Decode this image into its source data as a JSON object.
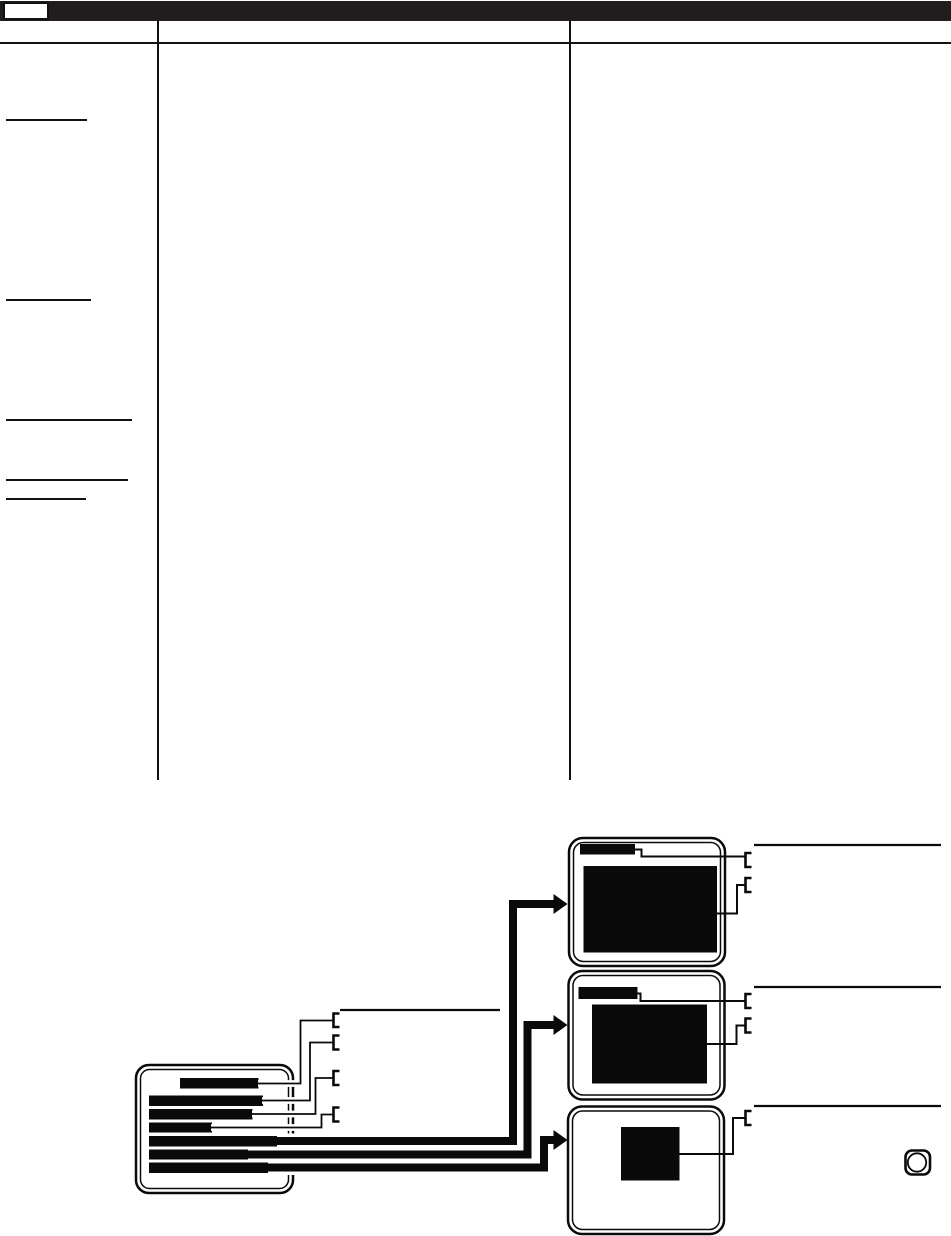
{
  "page": {
    "width": 951,
    "height": 1236,
    "background": "#ffffff",
    "ink_color": "#0a0a0a",
    "header_bar_color": "#211d1e",
    "page_number_box_label": ""
  },
  "left_column": {
    "redacted_heading_rules": [
      {
        "x": 6,
        "y": 118.5,
        "w": 81
      },
      {
        "x": 6,
        "y": 298.5,
        "w": 85
      },
      {
        "x": 6,
        "y": 418.5,
        "w": 126
      },
      {
        "x": 6,
        "y": 478.8,
        "w": 122
      },
      {
        "x": 6,
        "y": 497.8,
        "w": 80
      }
    ]
  },
  "diagram": {
    "menu_screen": {
      "frame": {
        "x": 136,
        "y": 1065,
        "w": 157,
        "h": 128,
        "r": 13
      },
      "menu_item_bars": [
        {
          "x": 180,
          "y": 1078,
          "w": 78.5,
          "h": 10.5,
          "role": "menu-title-bar"
        },
        {
          "x": 149,
          "y": 1095.5,
          "w": 114,
          "h": 10.5,
          "role": "menu-item-bar"
        },
        {
          "x": 149,
          "y": 1109,
          "w": 103.5,
          "h": 10.5,
          "role": "menu-item-bar"
        },
        {
          "x": 149,
          "y": 1122.5,
          "w": 63,
          "h": 10,
          "role": "menu-item-bar"
        },
        {
          "x": 149,
          "y": 1136,
          "w": 129,
          "h": 10.5,
          "role": "menu-item-bar"
        },
        {
          "x": 149,
          "y": 1149.5,
          "w": 101,
          "h": 10,
          "role": "menu-item-bar"
        },
        {
          "x": 149,
          "y": 1162.5,
          "w": 121,
          "h": 10.5,
          "role": "menu-item-bar"
        }
      ],
      "callout_lines": [
        "M211,1127.5 H321.5 V1114.5 H333",
        "M252,1114 H315.5 V1078 H333",
        "M262,1100.5 H310 V1042.5 H333",
        "M258,1083.5 H300.5 V1020.5 H333"
      ],
      "callout_brackets": [
        {
          "x": 333.5,
          "y1": 1013.5,
          "y2": 1027
        },
        {
          "x": 333.5,
          "y1": 1035.5,
          "y2": 1049.5
        },
        {
          "x": 333.5,
          "y1": 1071,
          "y2": 1085
        },
        {
          "x": 333.5,
          "y1": 1107.5,
          "y2": 1121.5
        }
      ],
      "label_rule": {
        "x1": 340,
        "y": 1010,
        "x2": 500
      }
    },
    "arrows": [
      {
        "path": "M277,1141 H513 V904 H554",
        "tip": [
          567.5,
          904
        ]
      },
      {
        "path": "M248,1154.5 H527.5 V1025 H554",
        "tip": [
          567.5,
          1025
        ]
      },
      {
        "path": "M268,1167.5 H544 V1140 H554",
        "tip": [
          567.5,
          1140
        ]
      }
    ],
    "tv_screens": [
      {
        "name": "tv-screen-1",
        "frame": {
          "x": 569,
          "y": 838,
          "w": 156,
          "h": 128,
          "r": 14
        },
        "title_bar": {
          "x": 580,
          "y": 844,
          "w": 55,
          "h": 10.5
        },
        "content_rect": {
          "x": 583.5,
          "y": 866,
          "w": 133.5,
          "h": 86.5
        },
        "callouts": [
          {
            "line": "M635,849.5 H641.5 V856.5 H745.5",
            "bracket": {
              "x": 745.5,
              "y1": 853,
              "y2": 867
            }
          },
          {
            "line": "M745.5,885 H737 V913.5 H717",
            "bracket": {
              "x": 745.5,
              "y1": 878,
              "y2": 892
            }
          }
        ],
        "label_rule": {
          "x1": 754,
          "y": 845,
          "x2": 941
        }
      },
      {
        "name": "tv-screen-2",
        "frame": {
          "x": 568.5,
          "y": 971,
          "w": 156,
          "h": 128.5,
          "r": 14
        },
        "title_bar": {
          "x": 578.5,
          "y": 987,
          "w": 59,
          "h": 12
        },
        "content_rect": {
          "x": 592,
          "y": 1004.5,
          "w": 115,
          "h": 79
        },
        "callouts": [
          {
            "line": "M637.5,993.5 H640.5 V1001 H745.5",
            "bracket": {
              "x": 745.5,
              "y1": 994,
              "y2": 1008
            }
          },
          {
            "line": "M745.5,1025.5 H736.5 V1044 H707",
            "bracket": {
              "x": 745.5,
              "y1": 1018.5,
              "y2": 1032.5
            }
          }
        ],
        "label_rule": {
          "x1": 754,
          "y": 987,
          "x2": 941
        }
      },
      {
        "name": "tv-screen-3",
        "frame": {
          "x": 568,
          "y": 1106.5,
          "w": 156,
          "h": 127.5,
          "r": 14
        },
        "content_rect": {
          "x": 621,
          "y": 1127,
          "w": 58.5,
          "h": 53.5
        },
        "callouts": [
          {
            "line": "M679.5,1154 H733 V1118 H745.5",
            "bracket": {
              "x": 745.5,
              "y1": 1111,
              "y2": 1125
            }
          }
        ],
        "label_rule": {
          "x1": 754,
          "y": 1106,
          "x2": 941
        }
      }
    ],
    "enter_button_icon": {
      "x": 905.5,
      "y": 1150.5,
      "w": 24.5,
      "h": 24,
      "r": 6.5,
      "circle": {
        "cx": 917,
        "cy": 1162.5,
        "r": 9.2
      }
    }
  }
}
